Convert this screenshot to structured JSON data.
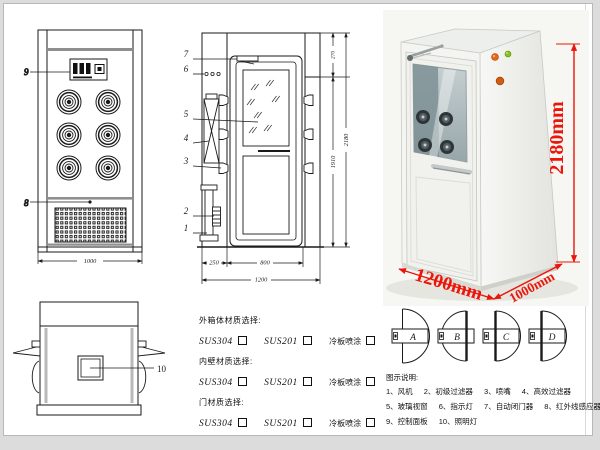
{
  "front_view": {
    "callouts": {
      "panel": "9",
      "sensor": "8"
    },
    "dim_width": "1000"
  },
  "side_view": {
    "callouts": [
      "7",
      "6",
      "5",
      "4",
      "3",
      "2",
      "1"
    ],
    "dims": {
      "left": "250",
      "door": "800",
      "total": "1200",
      "inner_height": "1910",
      "total_height": "2180",
      "top": "270"
    }
  },
  "top_view": {
    "callout_window": "10"
  },
  "photo": {
    "dims": {
      "height": "2180mm",
      "width": "1200mm",
      "depth": "1000mm"
    }
  },
  "door_options": {
    "labels": [
      "A",
      "B",
      "C",
      "D"
    ]
  },
  "materials": {
    "sections": [
      {
        "title": "外箱体材质选择:"
      },
      {
        "title": "内壁材质选择:"
      },
      {
        "title": "门材质选择:"
      }
    ],
    "options": [
      "SUS304",
      "SUS201",
      "冷板喷涂"
    ]
  },
  "legend": {
    "title": "图示说明:",
    "items": [
      "1、风机",
      "2、初级过滤器",
      "3、喷嘴",
      "4、高效过滤器",
      "5、玻璃视窗",
      "6、指示灯",
      "7、自动闭门器",
      "8、红外线感应器",
      "9、控制面板",
      "10、照明灯"
    ]
  },
  "colors": {
    "accent_red": "#ec1509",
    "line": "#1a1a1a",
    "gray_band": "#8f8f8f"
  }
}
